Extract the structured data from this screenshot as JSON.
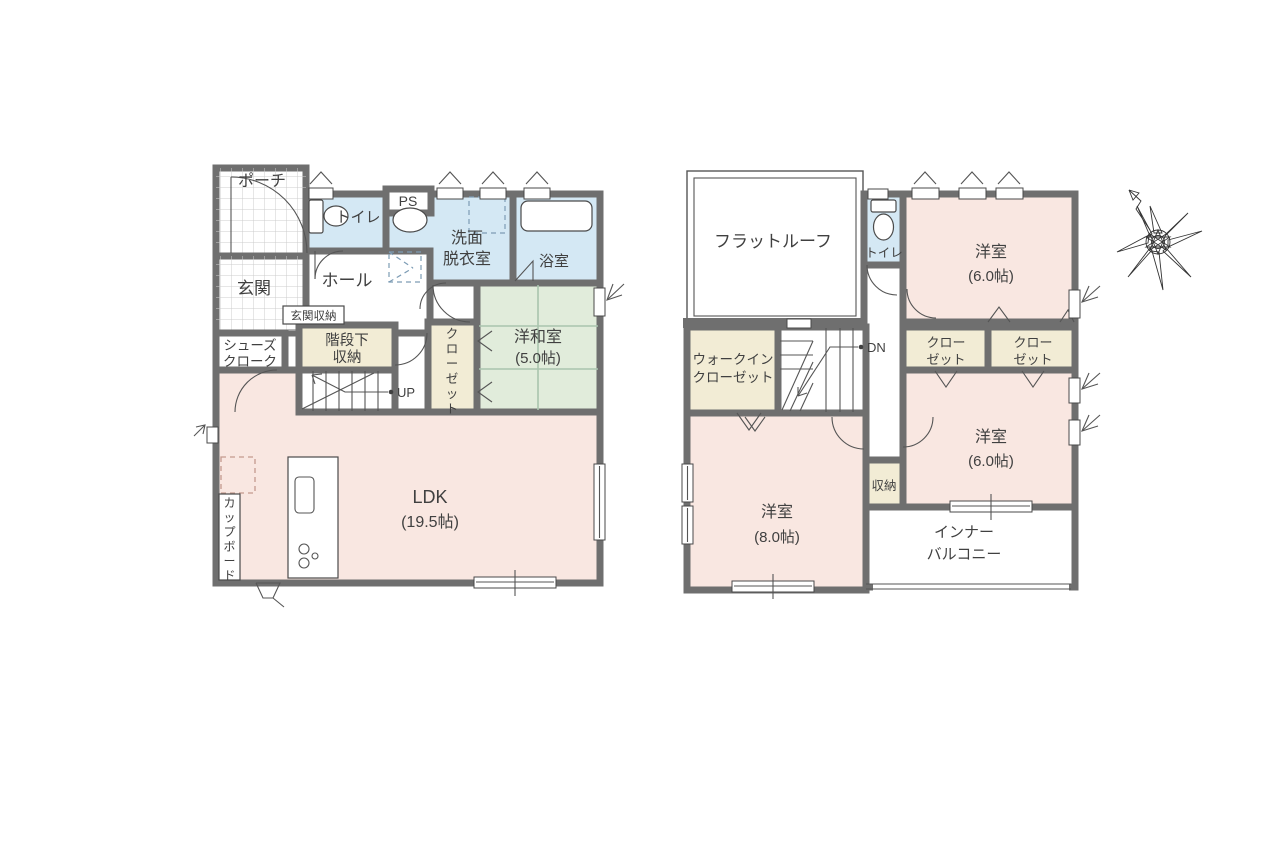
{
  "palette": {
    "wall": "#6f6f6f",
    "room_pink": "#f9e7e1",
    "room_green": "#e1ecdb",
    "room_blue": "#d4e8f4",
    "room_beige": "#f2ecd5",
    "tile_line": "#cccccc",
    "tatami_line": "#a9c4ae",
    "text": "#404040"
  },
  "floor1": {
    "porch": "ポーチ",
    "genkan": "玄関",
    "toilet": "トイレ",
    "ps": "PS",
    "senmen": {
      "line1": "洗面",
      "line2": "脱衣室"
    },
    "bath": "浴室",
    "hall": "ホール",
    "genkan_storage": "玄関収納",
    "shoes": {
      "line1": "シューズ",
      "line2": "クローク"
    },
    "under_stairs": {
      "line1": "階段下",
      "line2": "収納"
    },
    "closet": "クローゼット",
    "washitsu": {
      "name": "洋和室",
      "size": "(5.0帖)"
    },
    "up": "UP",
    "ldk": {
      "name": "LDK",
      "size": "(19.5帖)"
    },
    "cupboard": "カップボード"
  },
  "floor2": {
    "flat_roof": "フラットルーフ",
    "toilet": "トイレ",
    "bedroom_a": {
      "name": "洋室",
      "size": "(6.0帖)"
    },
    "wic": {
      "line1": "ウォークイン",
      "line2": "クローゼット"
    },
    "closet_left": {
      "line1": "クロー",
      "line2": "ゼット"
    },
    "closet_right": {
      "line1": "クロー",
      "line2": "ゼット"
    },
    "dn": "DN",
    "storage": "収納",
    "bedroom_b": {
      "name": "洋室",
      "size": "(8.0帖)"
    },
    "bedroom_c": {
      "name": "洋室",
      "size": "(6.0帖)"
    },
    "balcony": {
      "line1": "インナー",
      "line2": "バルコニー"
    }
  }
}
